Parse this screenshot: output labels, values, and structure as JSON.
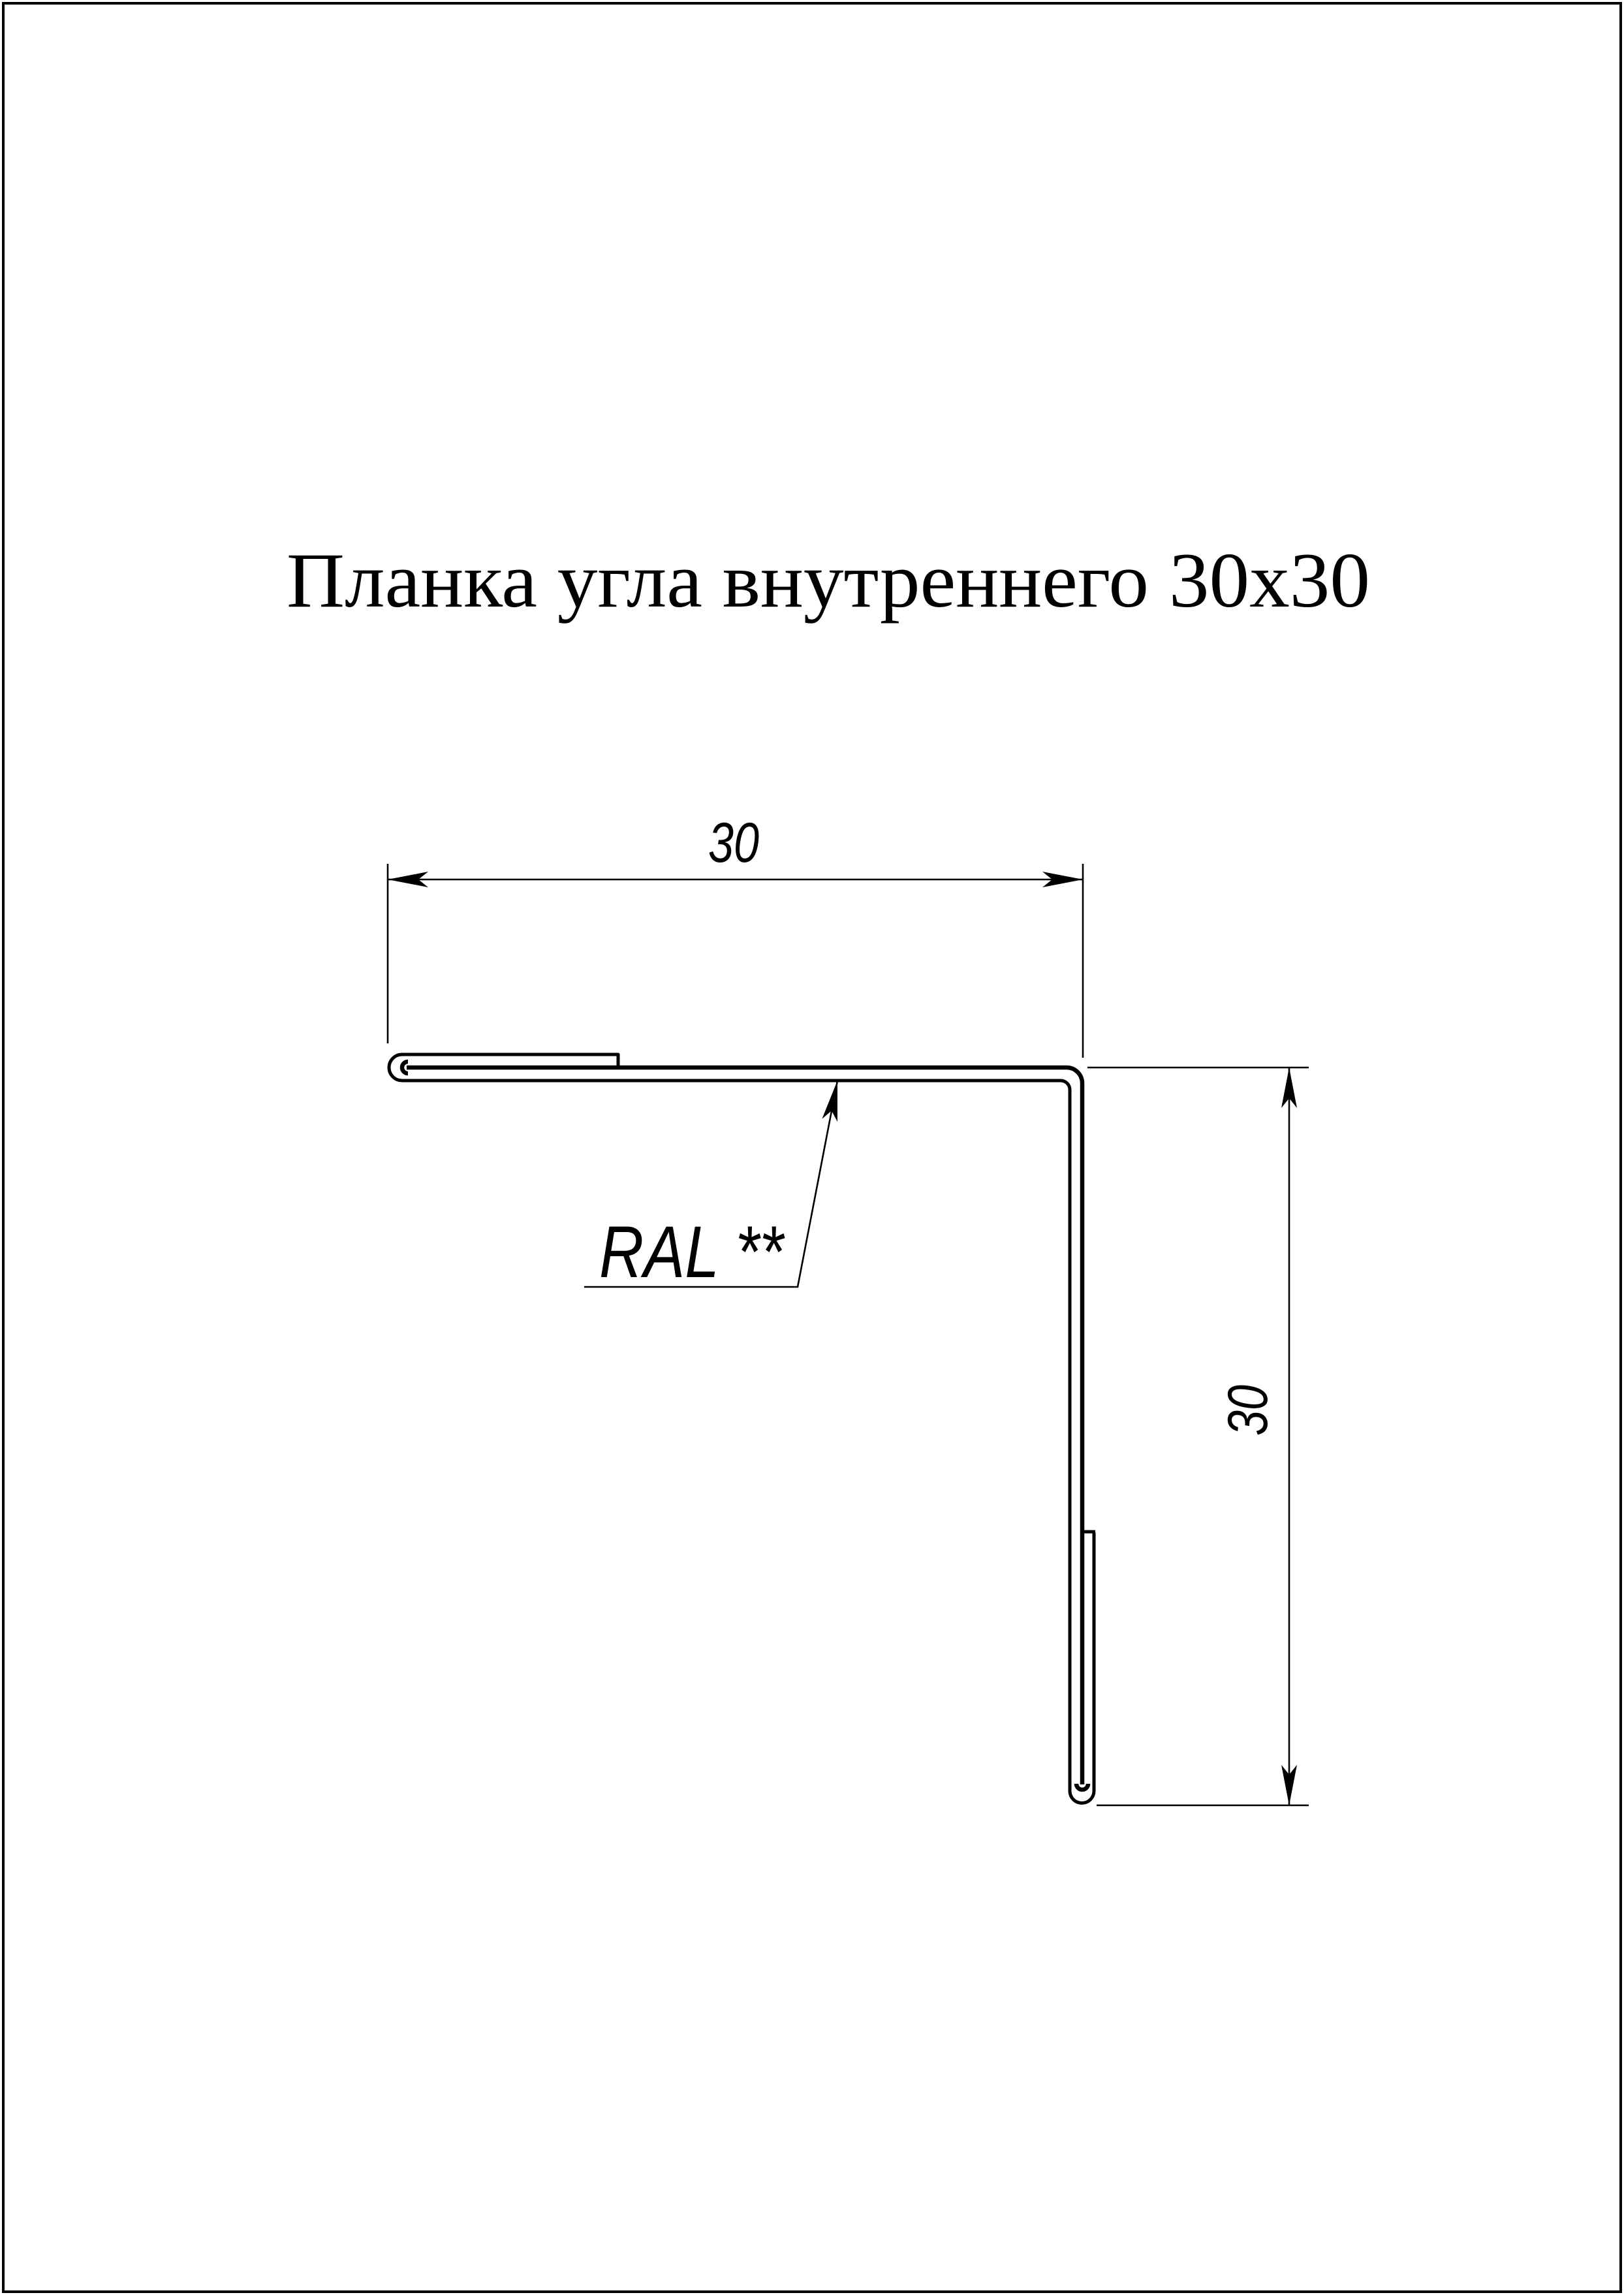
{
  "page": {
    "background_color": "#ffffff",
    "ink_color": "#000000"
  },
  "title": {
    "text": "Планка угла внутреннего 30x30"
  },
  "drawing": {
    "dimensions": {
      "horizontal": {
        "value": "30"
      },
      "vertical": {
        "value": "30"
      }
    },
    "labels": {
      "color_note": {
        "text": "RAL **"
      }
    }
  }
}
